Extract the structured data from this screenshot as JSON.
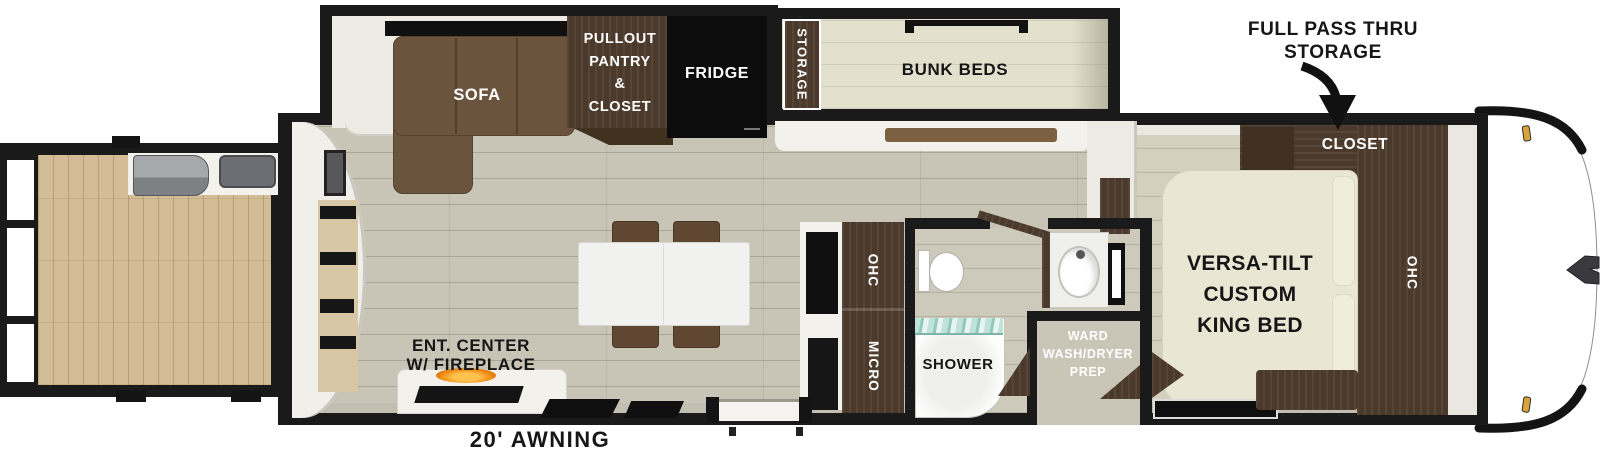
{
  "callout": {
    "pass_thru_lines": [
      "FULL PASS THRU",
      "STORAGE"
    ]
  },
  "exterior": {
    "awning": "20' AWNING"
  },
  "living": {
    "sofa": "SOFA",
    "pantry_lines": [
      "PULLOUT",
      "PANTRY",
      "&",
      "CLOSET"
    ],
    "fridge": "FRIDGE",
    "ent_center_lines": [
      "ENT. CENTER",
      "W/ FIREPLACE"
    ]
  },
  "kitchen": {
    "ohc": "OHC",
    "micro": "MICRO"
  },
  "bunkroom": {
    "storage": "STORAGE",
    "bunk_beds": "BUNK BEDS"
  },
  "bathroom": {
    "shower": "SHOWER",
    "ward_lines": [
      "WARD",
      "WASH/DRYER",
      "PREP"
    ]
  },
  "bedroom": {
    "closet": "CLOSET",
    "bed_lines": [
      "VERSA-TILT",
      "CUSTOM",
      "KING BED"
    ],
    "ohc": "OHC"
  },
  "colors": {
    "wall": "#1a1a1a",
    "cabinet": "#4b3a2b",
    "sofa": "#6b543d",
    "fridge": "#0c0c0c",
    "floor_main": "#c8c5b6",
    "floor_deck": "#d2bd97",
    "floor_bunk": "#e3e0cd",
    "bed": "#e9e6d3",
    "flame": "#f08a12",
    "shower_glass": "#aedacd",
    "clearance_light": "#d9a33c"
  }
}
